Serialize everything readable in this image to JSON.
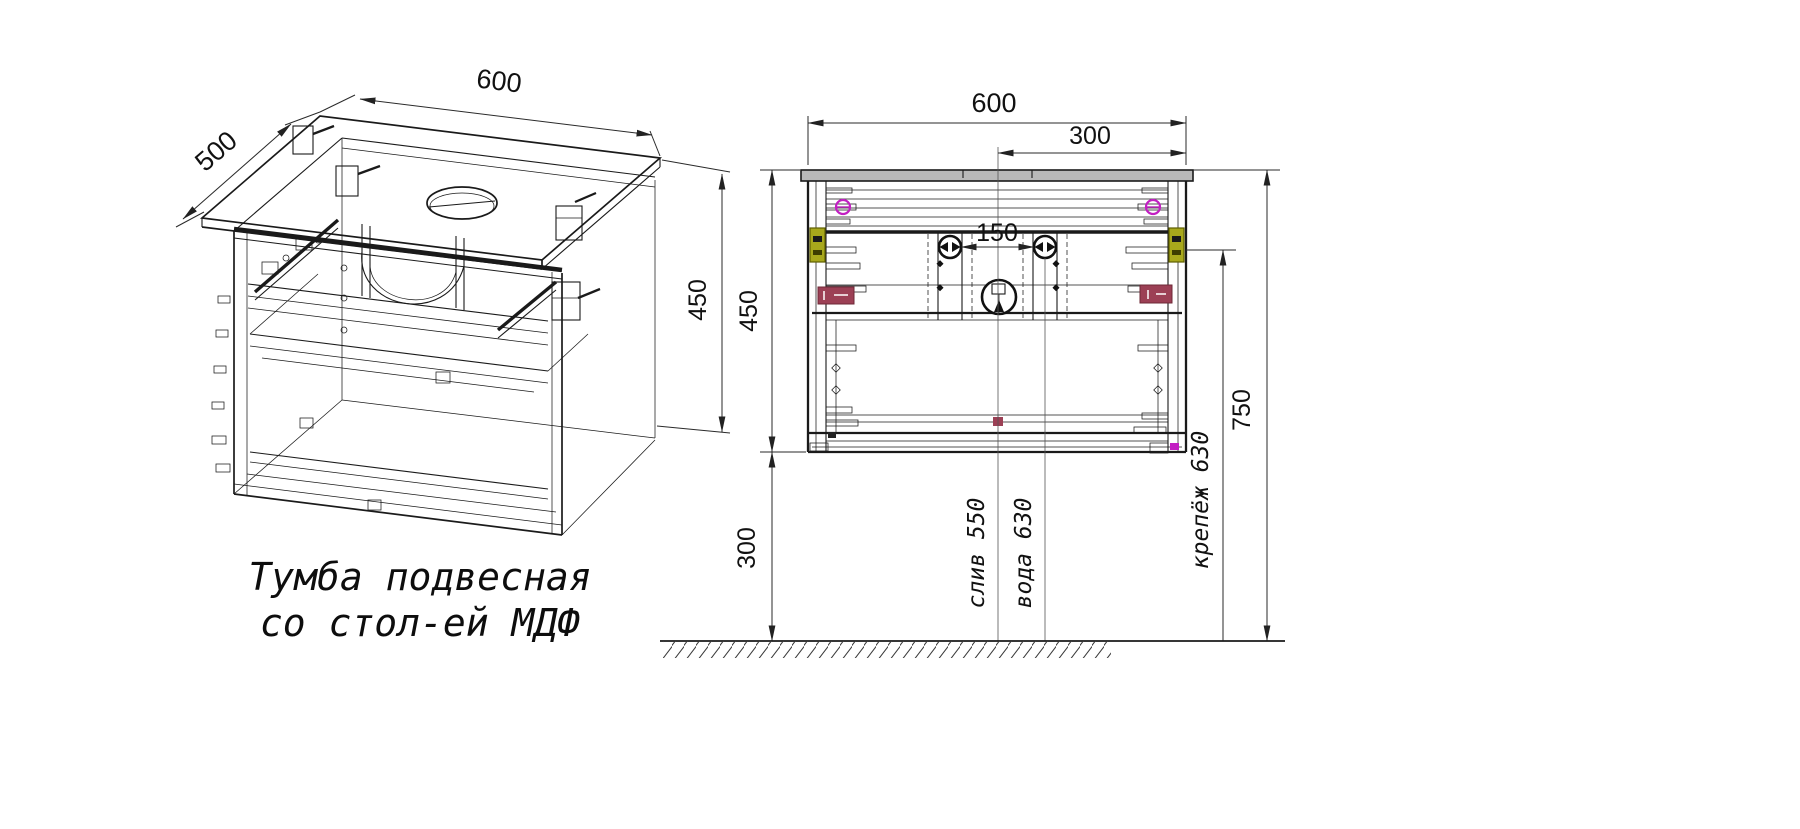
{
  "caption": {
    "line1": "Тумба подвесная",
    "line2": "со стол-ей МДФ"
  },
  "iso_view": {
    "dim_width": "600",
    "dim_depth": "500",
    "dim_height": "450"
  },
  "front_view": {
    "dim_width": "600",
    "dim_right_offset": "300",
    "dim_faucet_spacing": "150",
    "dim_height": "450",
    "dim_floor_gap": "300",
    "dim_total_height": "750",
    "label_drain": "слив 550",
    "label_water": "вода 630",
    "label_mount": "крепёж 630"
  },
  "colors": {
    "magenta": "#c21fc2",
    "olive": "#a8a81c",
    "olive_dark": "#5f5f00",
    "maroon": "#9c4055",
    "countertop": "#b9b9b9"
  }
}
